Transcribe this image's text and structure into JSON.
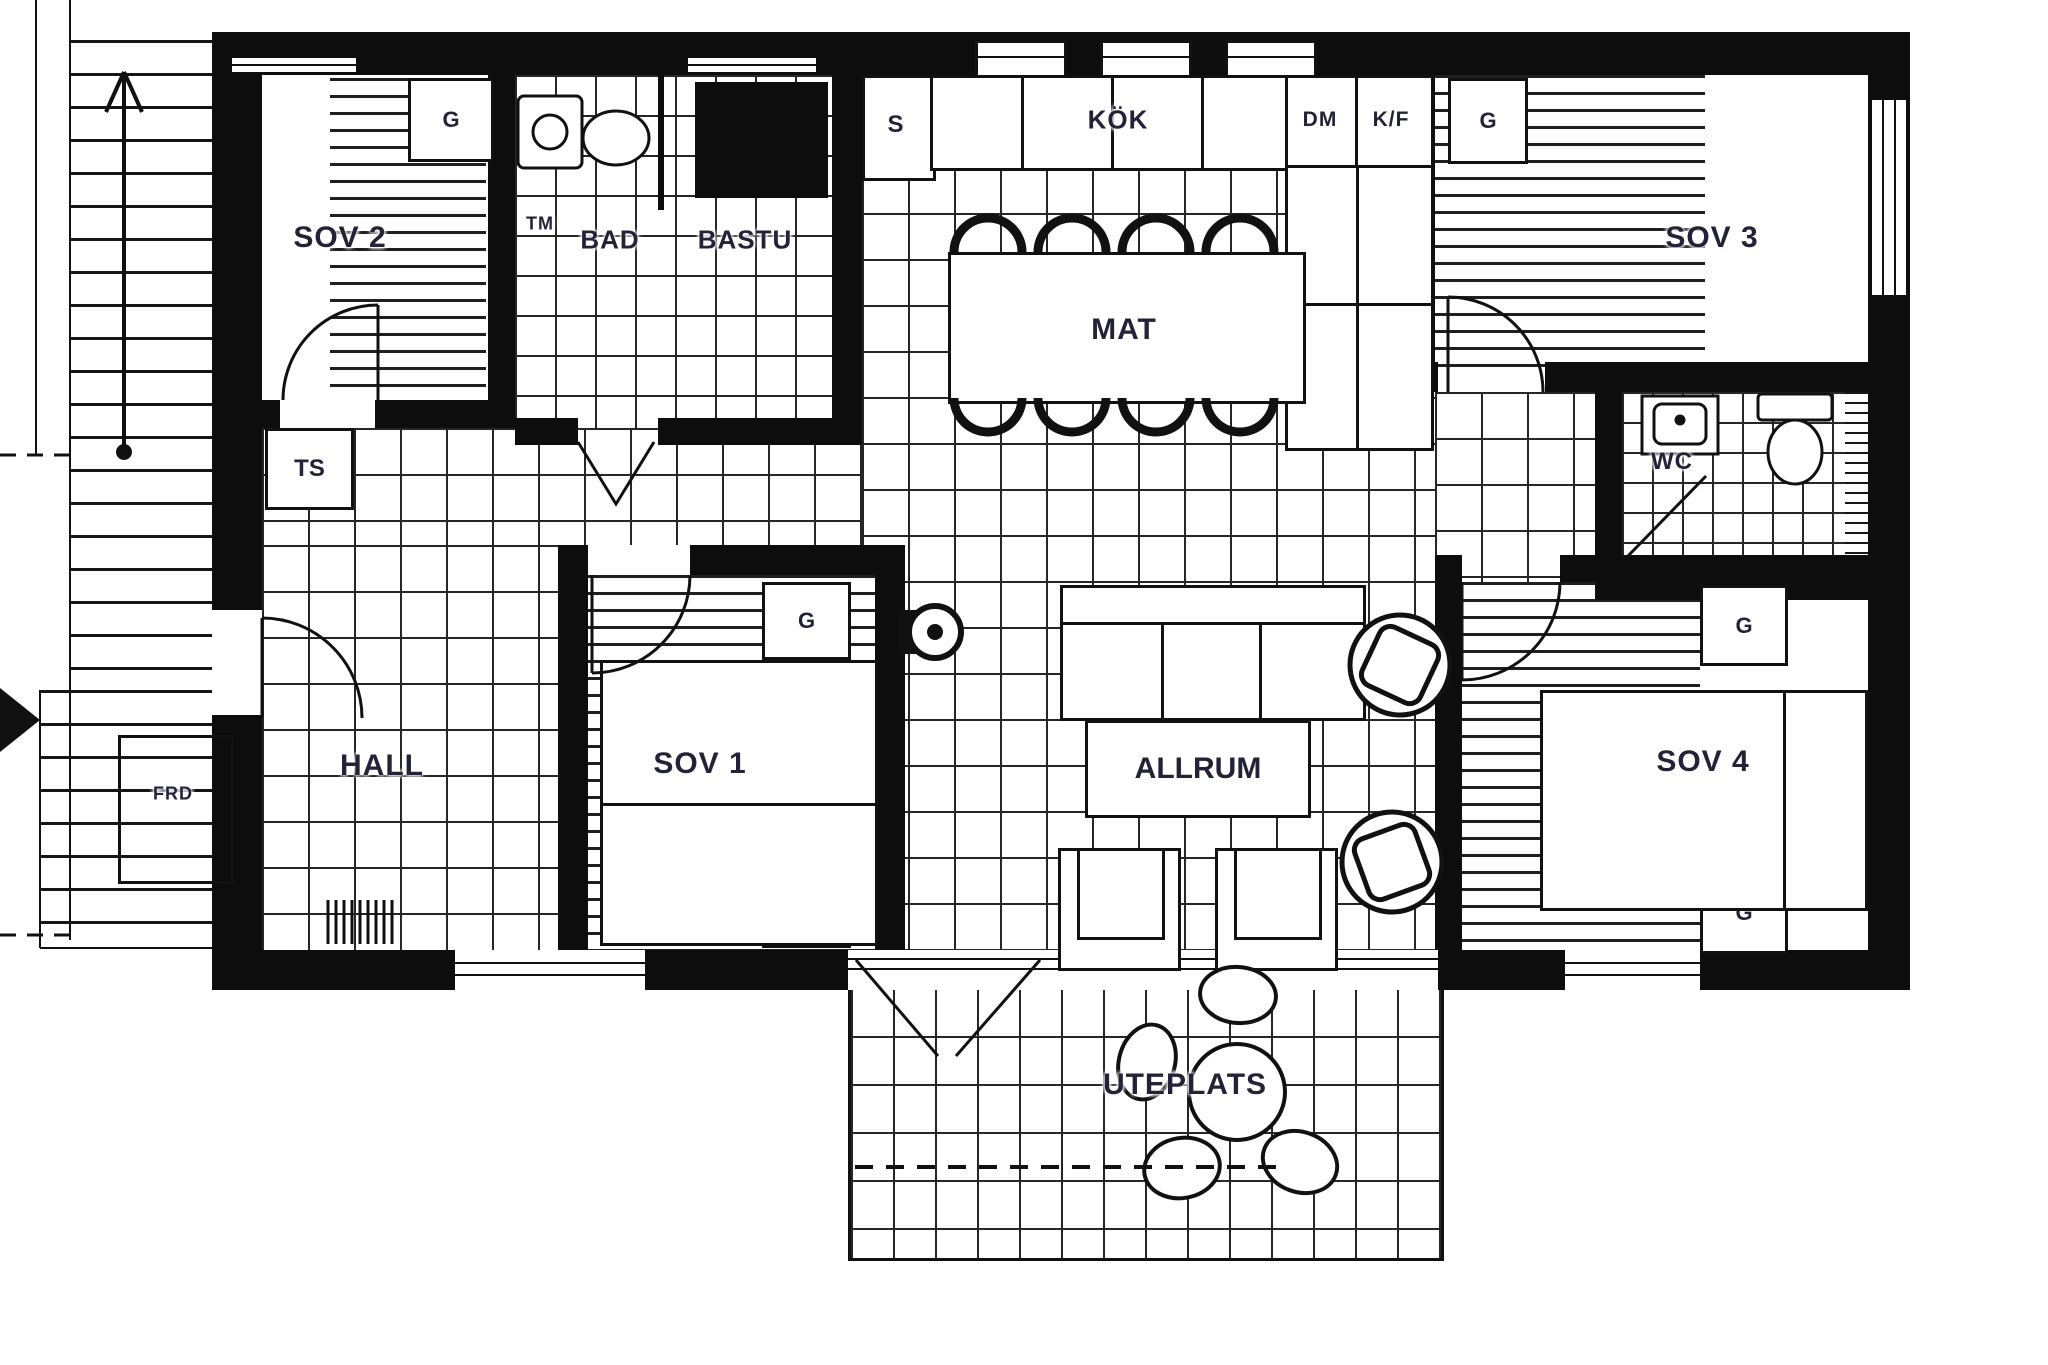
{
  "palette": {
    "ink": "#111111",
    "label": "#232338",
    "paper": "#ffffff"
  },
  "rooms": {
    "sov2": "SOV 2",
    "bad": "BAD",
    "bastu": "BASTU",
    "kok": "KÖK",
    "mat": "MAT",
    "sov3": "SOV 3",
    "wc": "WC",
    "hall": "HALL",
    "sov1": "SOV 1",
    "allrum": "ALLRUM",
    "sov4": "SOV 4",
    "uteplats": "UTEPLATS",
    "frd": "FRD"
  },
  "fixtures": {
    "tm": "TM",
    "ts": "TS",
    "s": "S",
    "dm": "DM",
    "kf": "K/F",
    "g": "G"
  }
}
